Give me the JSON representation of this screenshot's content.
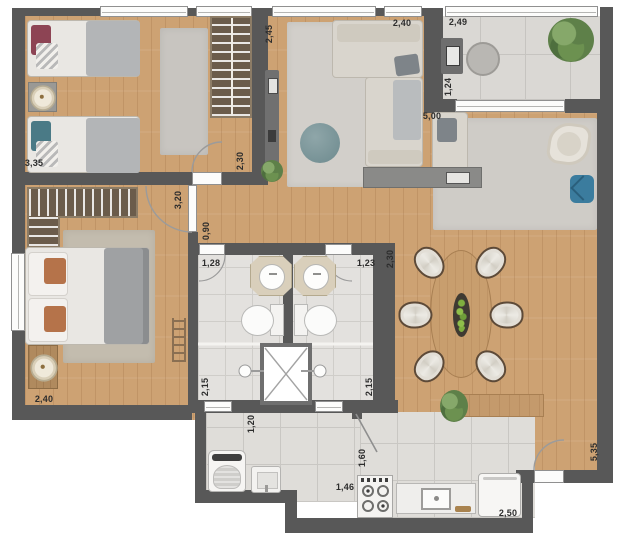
{
  "plan": {
    "type": "apartment-floor-plan",
    "dimension_labels": [
      {
        "text": "3,35",
        "x": 34,
        "y": 163,
        "rot": "h"
      },
      {
        "text": "2,45",
        "x": 269,
        "y": 34,
        "rot": "v"
      },
      {
        "text": "2,40",
        "x": 402,
        "y": 23,
        "rot": "h"
      },
      {
        "text": "2,49",
        "x": 458,
        "y": 22,
        "rot": "h"
      },
      {
        "text": "1,24",
        "x": 448,
        "y": 87,
        "rot": "v"
      },
      {
        "text": "5,00",
        "x": 432,
        "y": 116,
        "rot": "h"
      },
      {
        "text": "2,30",
        "x": 240,
        "y": 161,
        "rot": "v"
      },
      {
        "text": "3,20",
        "x": 178,
        "y": 200,
        "rot": "v"
      },
      {
        "text": "0,90",
        "x": 206,
        "y": 231,
        "rot": "v"
      },
      {
        "text": "1,28",
        "x": 211,
        "y": 263,
        "rot": "h"
      },
      {
        "text": "1,23",
        "x": 366,
        "y": 263,
        "rot": "h"
      },
      {
        "text": "2,30",
        "x": 390,
        "y": 259,
        "rot": "v"
      },
      {
        "text": "2,15",
        "x": 205,
        "y": 387,
        "rot": "v"
      },
      {
        "text": "2,15",
        "x": 369,
        "y": 387,
        "rot": "v"
      },
      {
        "text": "2,40",
        "x": 44,
        "y": 399,
        "rot": "h"
      },
      {
        "text": "1,20",
        "x": 251,
        "y": 424,
        "rot": "v"
      },
      {
        "text": "1,46",
        "x": 345,
        "y": 487,
        "rot": "h"
      },
      {
        "text": "1,60",
        "x": 362,
        "y": 458,
        "rot": "v"
      },
      {
        "text": "2,50",
        "x": 508,
        "y": 513,
        "rot": "h"
      },
      {
        "text": "5,35",
        "x": 594,
        "y": 452,
        "rot": "v"
      }
    ],
    "colors": {
      "wall": "#585858",
      "wood_floor": "#cda273",
      "tile_floor": "#dfddd9",
      "rug": "#cfccc7",
      "wardrobe": "#6b5c4b",
      "accent_teal": "#7c989c",
      "accent_blue": "#3b7c9e",
      "pillow_wine": "#8d4454",
      "pillow_teal": "#4a7a86",
      "pillow_rust": "#b5734a",
      "plant": "#5e8049",
      "label_text": "#2d2d2d"
    },
    "furniture": [
      {
        "room": "bedroom-1",
        "items": [
          "single-bed",
          "single-bed",
          "nightstand-lamp",
          "rug",
          "wardrobe"
        ]
      },
      {
        "room": "living",
        "items": [
          "sectional-sofa",
          "pouf",
          "rug",
          "tv-panel",
          "media-console"
        ]
      },
      {
        "room": "balcony-office",
        "items": [
          "desk",
          "office-chair",
          "plant"
        ]
      },
      {
        "room": "tv-corner",
        "items": [
          "armchair",
          "side-ottoman",
          "rug"
        ]
      },
      {
        "room": "master-bedroom",
        "items": [
          "double-bed",
          "nightstand-lamp",
          "rug",
          "l-closet",
          "decor-ladder"
        ]
      },
      {
        "room": "bathroom-left",
        "items": [
          "vanity-sink",
          "toilet",
          "shower"
        ]
      },
      {
        "room": "bathroom-right",
        "items": [
          "vanity-sink",
          "toilet",
          "shower"
        ]
      },
      {
        "room": "shaft",
        "items": [
          "duct-x"
        ]
      },
      {
        "room": "laundry",
        "items": [
          "washing-machine",
          "utility-sink"
        ]
      },
      {
        "room": "kitchen",
        "items": [
          "stove",
          "counter-sink",
          "refrigerator",
          "bench-plant"
        ]
      },
      {
        "room": "dining",
        "items": [
          "oval-table",
          "chairs-6",
          "centerpiece"
        ]
      }
    ]
  }
}
